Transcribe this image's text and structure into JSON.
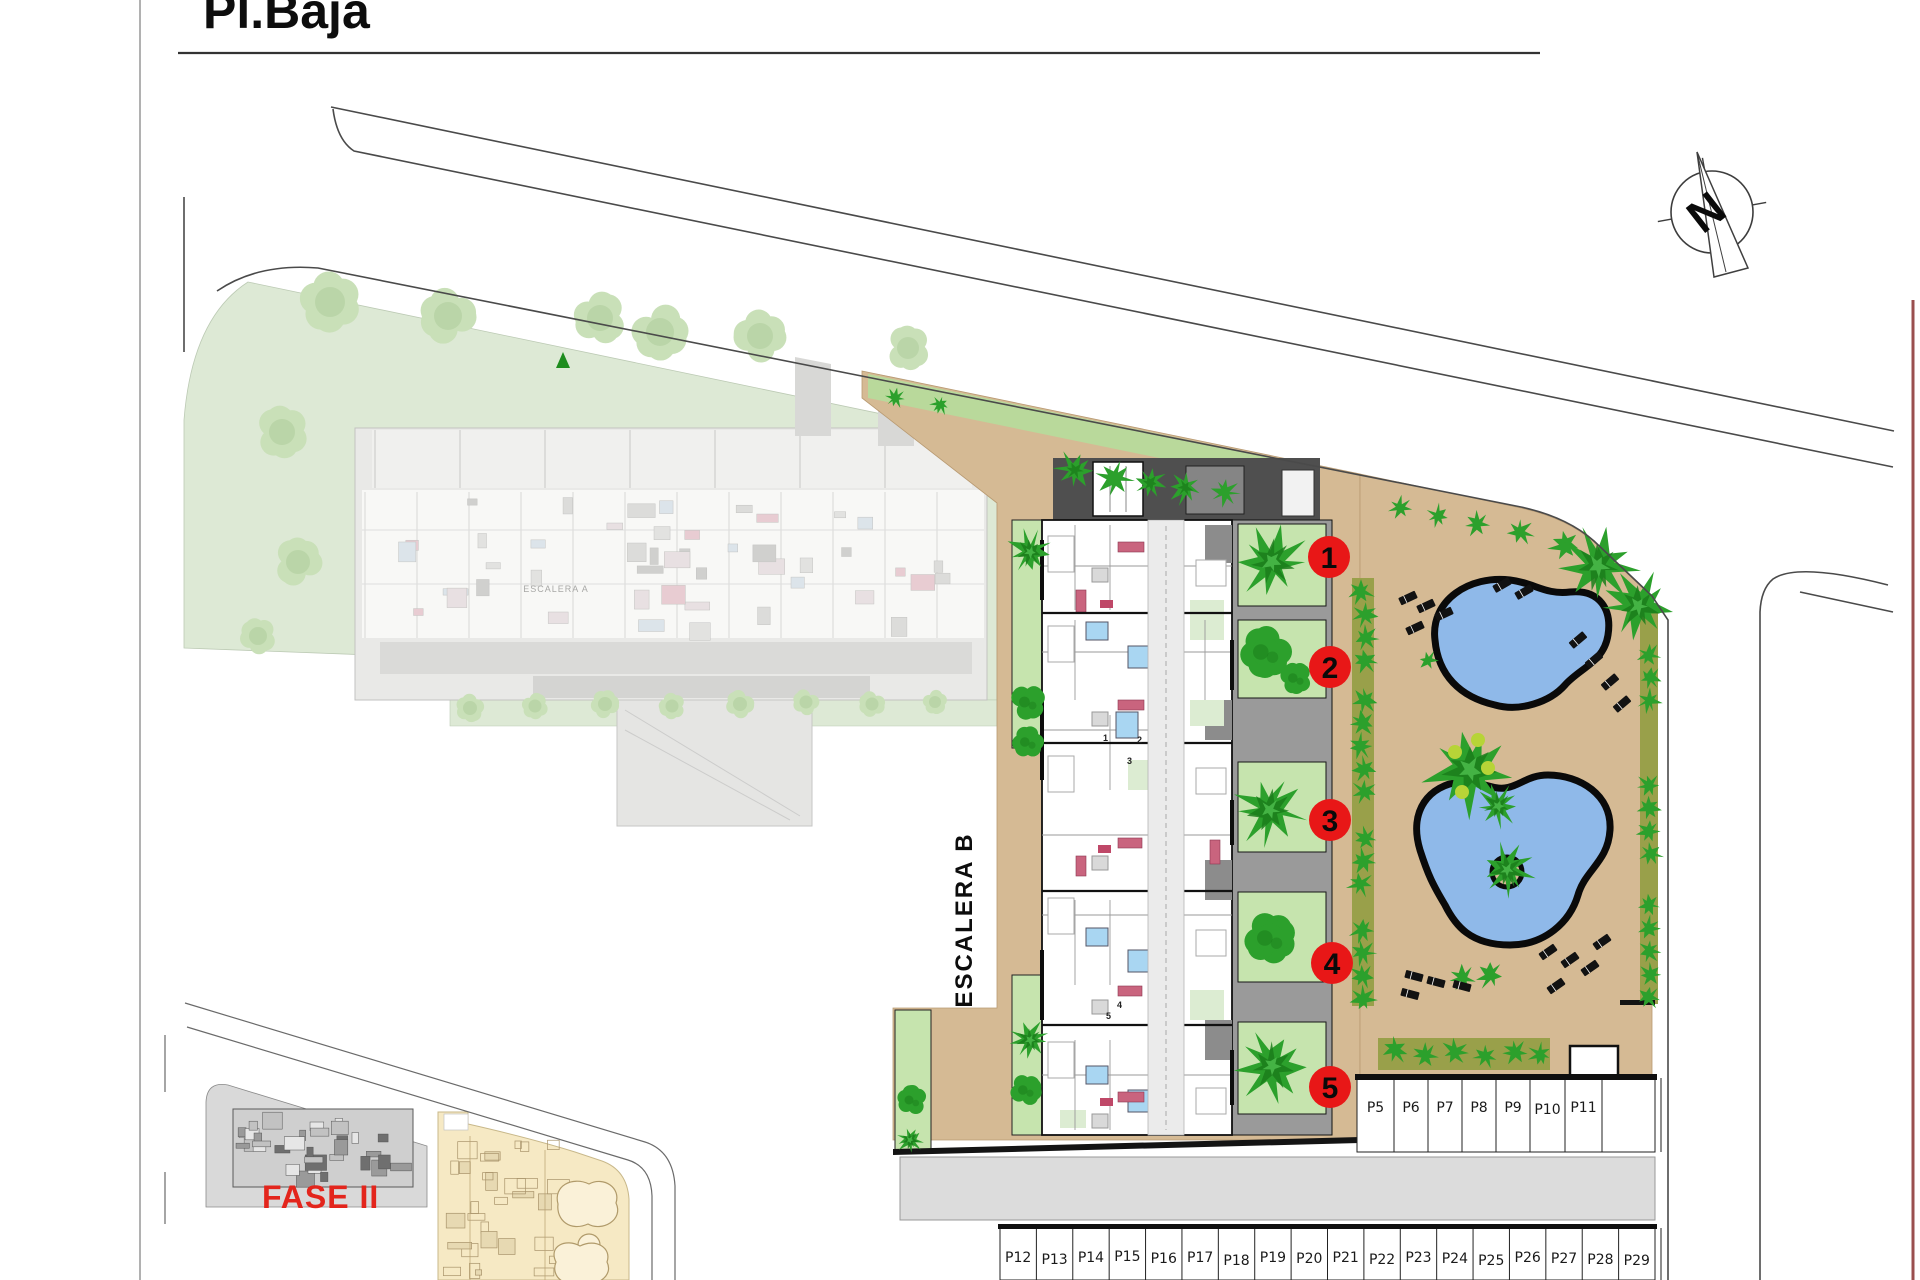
{
  "title": {
    "text": "Pl.Baja"
  },
  "compass": {
    "north_label": "N"
  },
  "areas": {
    "escalera_a_label": "ESCALERA A",
    "escalera_b_label": "ESCALERA B",
    "fase2_label": "FASE II"
  },
  "unit_markers": [
    {
      "number": "1"
    },
    {
      "number": "2"
    },
    {
      "number": "3"
    },
    {
      "number": "4"
    },
    {
      "number": "5"
    }
  ],
  "unit_plan_digits": [
    "1",
    "2",
    "3",
    "4",
    "5"
  ],
  "parking": {
    "upper_row": [
      "P5",
      "P6",
      "P7",
      "P8",
      "P9",
      "P10",
      "P11"
    ],
    "lower_row": [
      "P12",
      "P13",
      "P14",
      "P15",
      "P16",
      "P17",
      "P18",
      "P19",
      "P20",
      "P21",
      "P22",
      "P23",
      "P24",
      "P25",
      "P26",
      "P27",
      "P28",
      "P29"
    ]
  },
  "colors": {
    "tan": "#d5ba94",
    "lawn": "#b9d99b",
    "garden": "#c6e4ae",
    "tree_green": "#2ca02c",
    "tree_dark": "#1b7d1b",
    "tree_light": "#49b849",
    "hedge_olive": "#99a04a",
    "pool_blue": "#8fb9e9",
    "marker_red": "#e81717",
    "fase2_red": "#e3251c",
    "faded_green": "#dde9d5",
    "faded_tree": "#c9e0b8",
    "road_gray": "#dcdcdc",
    "roof_dark": "#4f4f4f",
    "yellow_parcel": "#f6e9c4",
    "maroon_border": "#9a4f4f",
    "bath_blue": "#a9d6f2",
    "sofa_pink": "#c9647e"
  }
}
